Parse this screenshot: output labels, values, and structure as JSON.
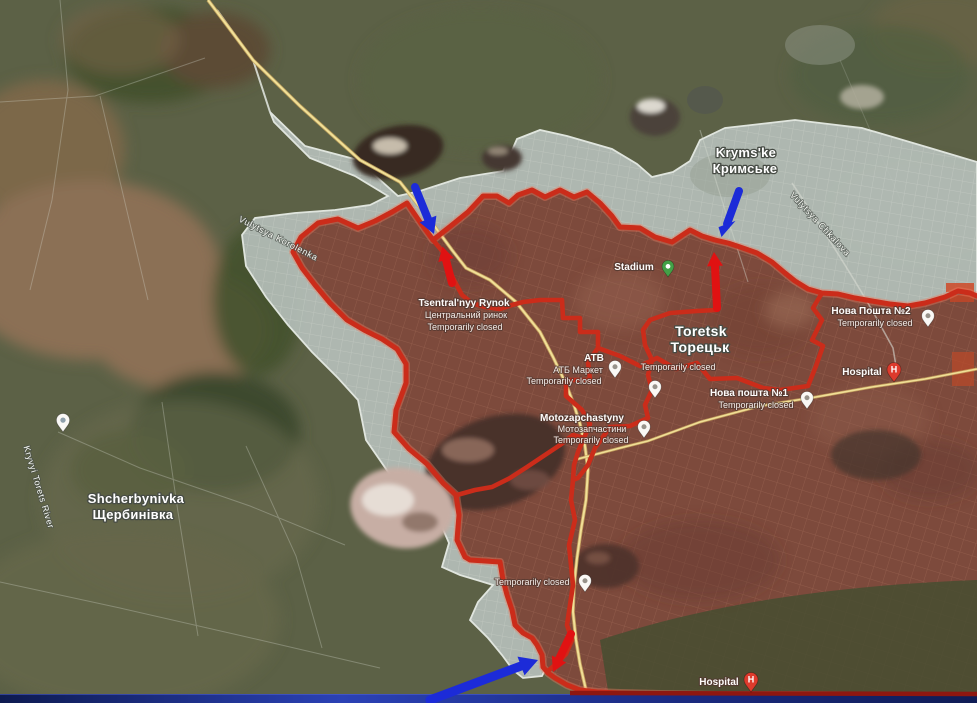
{
  "map": {
    "towns": {
      "krymske": {
        "latin": "Kryms'ke",
        "cyrillic": "Кримське"
      },
      "toretsk": {
        "latin": "Toretsk",
        "cyrillic": "Торецьк"
      },
      "shcherbynivka": {
        "latin": "Shcherbynivka",
        "cyrillic": "Щербинівка"
      }
    },
    "streets": {
      "korolenka": "Vulytsya Korolenka",
      "chkalova": "Vulytsya Chkalova",
      "river": "Kryvyi Torets River"
    },
    "pois": {
      "rynok": {
        "name": "Tsentral'nyy Rynok",
        "local": "Центральний ринок",
        "status": "Temporarily closed"
      },
      "stadium": {
        "name": "Stadium"
      },
      "atb": {
        "name": "ATB",
        "local": "АТБ Маркет",
        "status": "Temporarily closed"
      },
      "closed_center": {
        "status": "Temporarily closed"
      },
      "moto": {
        "name": "Motozapchastyny",
        "local": "Мотозапчастини",
        "status": "Temporarily closed"
      },
      "nova_poshta_1": {
        "name": "Нова пошта №1",
        "status": "Temporarily closed"
      },
      "nova_poshta_2": {
        "name": "Нова Пошта №2",
        "status": "Temporarily closed"
      },
      "hospital_east": {
        "name": "Hospital"
      },
      "hospital_south": {
        "name": "Hospital"
      },
      "closed_south": {
        "status": "Temporarily closed"
      }
    },
    "icons": {
      "hospital_glyph": "H"
    },
    "colors": {
      "front_line": "#cb2c1a",
      "front_line_glow": "#ef7a60",
      "red_arrow": "#e01212",
      "blue_arrow": "#1c2bd8",
      "contested_zone_border": "#ecf1ec",
      "road": "#f3e49b"
    }
  }
}
